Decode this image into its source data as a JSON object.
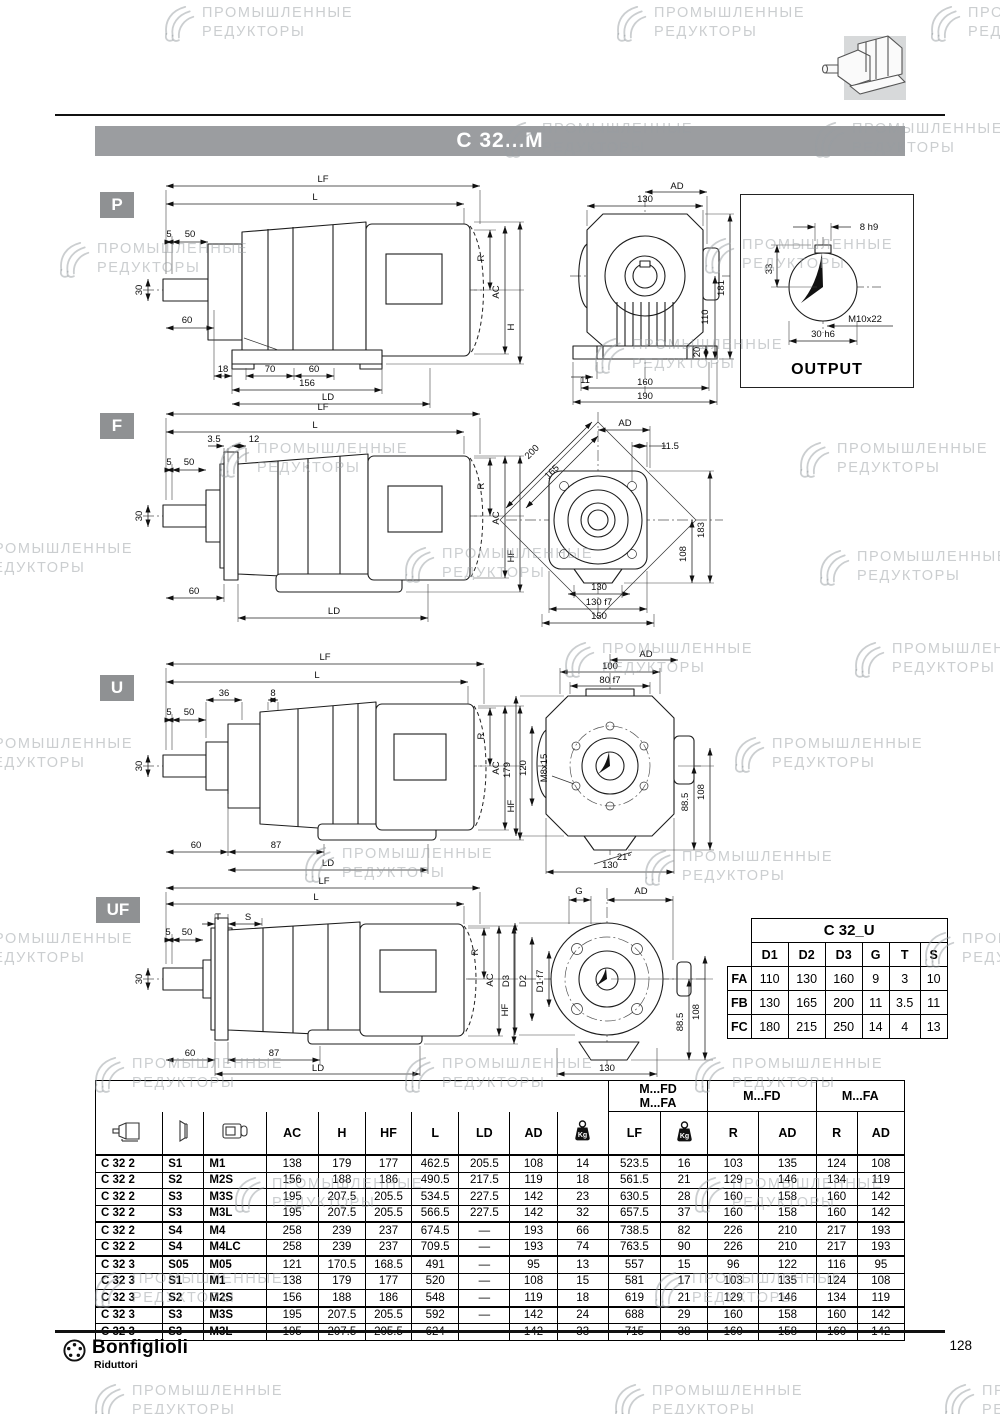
{
  "page": {
    "title": "C 32...M",
    "page_number": "128",
    "brand": "Bonfiglioli",
    "brand_sub": "Riduttori"
  },
  "icons": {
    "gearbox": "gearbox-icon",
    "flange": "flange-icon",
    "motor": "motor-icon",
    "kg": "kg-icon",
    "brand": "bonfiglioli-logo"
  },
  "sections": {
    "p": {
      "badge": "P"
    },
    "f": {
      "badge": "F"
    },
    "u": {
      "badge": "U"
    },
    "uf": {
      "badge": "UF"
    }
  },
  "watermarks": {
    "line1": "ПРОМЫШЛЕННЫЕ",
    "line2": "РЕДУКТОРЫ",
    "items": [
      {
        "x": 160,
        "y": 4
      },
      {
        "x": 612,
        "y": 4
      },
      {
        "x": 926,
        "y": 4
      },
      {
        "x": 500,
        "y": 120
      },
      {
        "x": 810,
        "y": 120
      },
      {
        "x": 55,
        "y": 240
      },
      {
        "x": 700,
        "y": 236
      },
      {
        "x": 590,
        "y": 336
      },
      {
        "x": 215,
        "y": 440
      },
      {
        "x": 795,
        "y": 440
      },
      {
        "x": -60,
        "y": 540
      },
      {
        "x": 400,
        "y": 545
      },
      {
        "x": 815,
        "y": 548
      },
      {
        "x": 560,
        "y": 640
      },
      {
        "x": 850,
        "y": 640
      },
      {
        "x": -60,
        "y": 735
      },
      {
        "x": 730,
        "y": 735
      },
      {
        "x": 300,
        "y": 845
      },
      {
        "x": 640,
        "y": 848
      },
      {
        "x": -60,
        "y": 930
      },
      {
        "x": 920,
        "y": 930
      },
      {
        "x": 90,
        "y": 1055
      },
      {
        "x": 400,
        "y": 1055
      },
      {
        "x": 690,
        "y": 1055
      },
      {
        "x": 230,
        "y": 1175
      },
      {
        "x": 690,
        "y": 1175
      },
      {
        "x": 90,
        "y": 1270
      },
      {
        "x": 650,
        "y": 1270
      },
      {
        "x": 90,
        "y": 1382
      },
      {
        "x": 610,
        "y": 1382
      },
      {
        "x": 940,
        "y": 1382
      }
    ]
  },
  "drawings": {
    "p_side": {
      "labels": [
        {
          "t": "LF",
          "x": 195,
          "y": 12
        },
        {
          "t": "L",
          "x": 187,
          "y": 30
        },
        {
          "t": "5",
          "x": 41,
          "y": 67,
          "fs": 8.5
        },
        {
          "t": "50",
          "x": 62,
          "y": 67,
          "fs": 8.5
        },
        {
          "t": "30",
          "x": 14,
          "y": 120,
          "r": -90,
          "fs": 8.5
        },
        {
          "t": "60",
          "x": 59,
          "y": 153,
          "fs": 8.5
        },
        {
          "t": "18",
          "x": 95,
          "y": 202,
          "fs": 8.5
        },
        {
          "t": "70",
          "x": 142,
          "y": 202,
          "fs": 8.5
        },
        {
          "t": "60",
          "x": 186,
          "y": 202,
          "fs": 8.5
        },
        {
          "t": "156",
          "x": 179,
          "y": 216
        },
        {
          "t": "LD",
          "x": 200,
          "y": 230
        },
        {
          "t": "R",
          "x": 356,
          "y": 88,
          "r": -90
        },
        {
          "t": "AC",
          "x": 371,
          "y": 122,
          "r": -90
        },
        {
          "t": "H",
          "x": 386,
          "y": 157,
          "r": -90
        }
      ]
    },
    "p_rear": {
      "labels": [
        {
          "t": "AD",
          "x": 132,
          "y": 9
        },
        {
          "t": "130",
          "x": 100,
          "y": 22
        },
        {
          "t": "181",
          "x": 179,
          "y": 108,
          "r": -90
        },
        {
          "t": "110",
          "x": 163,
          "y": 137,
          "r": -90
        },
        {
          "t": "20",
          "x": 155,
          "y": 172,
          "r": -90,
          "fs": 8
        },
        {
          "t": "11",
          "x": 40,
          "y": 203,
          "fs": 8.5
        },
        {
          "t": "160",
          "x": 100,
          "y": 205
        },
        {
          "t": "190",
          "x": 100,
          "y": 219
        }
      ]
    },
    "output": {
      "caption": "OUTPUT",
      "labels": [
        {
          "t": "8 h9",
          "x": 128,
          "y": 35,
          "fs": 8.5
        },
        {
          "t": "33",
          "x": 31,
          "y": 74,
          "r": -90
        },
        {
          "t": "M10x22",
          "x": 124,
          "y": 127
        },
        {
          "t": "30 h6",
          "x": 82,
          "y": 142
        }
      ]
    },
    "f_side": {
      "labels": [
        {
          "t": "LF",
          "x": 195,
          "y": 12
        },
        {
          "t": "L",
          "x": 187,
          "y": 30
        },
        {
          "t": "3.5",
          "x": 86,
          "y": 44,
          "fs": 8.5
        },
        {
          "t": "12",
          "x": 126,
          "y": 44,
          "fs": 8.5
        },
        {
          "t": "5",
          "x": 41,
          "y": 67,
          "fs": 8.5
        },
        {
          "t": "50",
          "x": 61,
          "y": 67,
          "fs": 8.5
        },
        {
          "t": "30",
          "x": 14,
          "y": 118,
          "r": -90,
          "fs": 8.5
        },
        {
          "t": "60",
          "x": 66,
          "y": 196,
          "fs": 8.5
        },
        {
          "t": "LD",
          "x": 206,
          "y": 216
        },
        {
          "t": "R",
          "x": 356,
          "y": 88,
          "r": -90
        },
        {
          "t": "AC",
          "x": 371,
          "y": 120,
          "r": -90
        },
        {
          "t": "HF",
          "x": 386,
          "y": 158,
          "r": -90
        }
      ]
    },
    "f_rear": {
      "labels": [
        {
          "t": "AD",
          "x": 127,
          "y": 24
        },
        {
          "t": "11.5",
          "x": 172,
          "y": 47,
          "fs": 8.5
        },
        {
          "t": "200",
          "x": 36,
          "y": 52,
          "r": -45
        },
        {
          "t": "165",
          "x": 56,
          "y": 72,
          "r": -45
        },
        {
          "t": "183",
          "x": 206,
          "y": 128,
          "r": -90
        },
        {
          "t": "108",
          "x": 188,
          "y": 152,
          "r": -90
        },
        {
          "t": "130",
          "x": 101,
          "y": 188
        },
        {
          "t": "130 f7",
          "x": 101,
          "y": 203,
          "fs": 9
        },
        {
          "t": "150",
          "x": 101,
          "y": 217
        }
      ]
    },
    "u_side": {
      "labels": [
        {
          "t": "LF",
          "x": 197,
          "y": 12
        },
        {
          "t": "L",
          "x": 189,
          "y": 30
        },
        {
          "t": "36",
          "x": 96,
          "y": 48,
          "fs": 8.5
        },
        {
          "t": "8",
          "x": 145,
          "y": 48,
          "fs": 8.5
        },
        {
          "t": "5",
          "x": 41,
          "y": 67,
          "fs": 8.5
        },
        {
          "t": "50",
          "x": 61,
          "y": 67,
          "fs": 8.5
        },
        {
          "t": "30",
          "x": 14,
          "y": 118,
          "r": -90,
          "fs": 8.5
        },
        {
          "t": "60",
          "x": 68,
          "y": 200,
          "fs": 8.5
        },
        {
          "t": "87",
          "x": 148,
          "y": 200,
          "fs": 8.5
        },
        {
          "t": "LD",
          "x": 200,
          "y": 218
        },
        {
          "t": "R",
          "x": 356,
          "y": 88,
          "r": -90
        },
        {
          "t": "AC",
          "x": 371,
          "y": 120,
          "r": -90
        },
        {
          "t": "HF",
          "x": 386,
          "y": 158,
          "r": -90
        }
      ]
    },
    "u_rear": {
      "labels": [
        {
          "t": "AD",
          "x": 148,
          "y": 7
        },
        {
          "t": "100",
          "x": 112,
          "y": 19
        },
        {
          "t": "80 f7",
          "x": 112,
          "y": 33,
          "fs": 9
        },
        {
          "t": "179",
          "x": 12,
          "y": 120,
          "r": -90
        },
        {
          "t": "120",
          "x": 28,
          "y": 118,
          "r": -90
        },
        {
          "t": "M8x15",
          "x": 49,
          "y": 118,
          "r": -90,
          "fs": 8.5
        },
        {
          "t": "88.5",
          "x": 190,
          "y": 152,
          "r": -90
        },
        {
          "t": "108",
          "x": 206,
          "y": 142,
          "r": -90
        },
        {
          "t": "21°",
          "x": 126,
          "y": 210,
          "fs": 8.5
        },
        {
          "t": "130",
          "x": 112,
          "y": 218
        }
      ]
    },
    "uf_side": {
      "labels": [
        {
          "t": "LF",
          "x": 196,
          "y": 10
        },
        {
          "t": "L",
          "x": 188,
          "y": 26
        },
        {
          "t": "T",
          "x": 90,
          "y": 46,
          "fs": 9
        },
        {
          "t": "S",
          "x": 120,
          "y": 46,
          "fs": 9
        },
        {
          "t": "5",
          "x": 40,
          "y": 61,
          "fs": 8.5
        },
        {
          "t": "50",
          "x": 59,
          "y": 61,
          "fs": 8.5
        },
        {
          "t": "30",
          "x": 14,
          "y": 105,
          "r": -90,
          "fs": 8.5
        },
        {
          "t": "60",
          "x": 62,
          "y": 182,
          "fs": 8.5
        },
        {
          "t": "87",
          "x": 146,
          "y": 182,
          "fs": 8.5
        },
        {
          "t": "LD",
          "x": 190,
          "y": 197
        },
        {
          "t": "R",
          "x": 350,
          "y": 78,
          "r": -90
        },
        {
          "t": "AC",
          "x": 365,
          "y": 106,
          "r": -90
        },
        {
          "t": "HF",
          "x": 380,
          "y": 136,
          "r": -90
        }
      ]
    },
    "uf_rear": {
      "labels": [
        {
          "t": "G",
          "x": 84,
          "y": 10
        },
        {
          "t": "AD",
          "x": 146,
          "y": 10
        },
        {
          "t": "D3",
          "x": 14,
          "y": 97,
          "r": -90
        },
        {
          "t": "D2",
          "x": 31,
          "y": 97,
          "r": -90
        },
        {
          "t": "D1 f7",
          "x": 48,
          "y": 97,
          "r": -90,
          "fs": 8.5
        },
        {
          "t": "88.5",
          "x": 188,
          "y": 138,
          "r": -90
        },
        {
          "t": "108",
          "x": 204,
          "y": 128,
          "r": -90
        },
        {
          "t": "130",
          "x": 112,
          "y": 187
        }
      ]
    }
  },
  "c32u": {
    "title": "C 32_U",
    "columns": [
      "D1",
      "D2",
      "D3",
      "G",
      "T",
      "S"
    ],
    "rows": [
      {
        "label": "FA",
        "values": [
          "110",
          "130",
          "160",
          "9",
          "3",
          "10"
        ]
      },
      {
        "label": "FB",
        "values": [
          "130",
          "165",
          "200",
          "11",
          "3.5",
          "11"
        ]
      },
      {
        "label": "FC",
        "values": [
          "180",
          "215",
          "250",
          "14",
          "4",
          "13"
        ]
      }
    ]
  },
  "main_table": {
    "group_fd_fa_line1": "M...FD",
    "group_fd_fa_line2": "M...FA",
    "group_fd": "M...FD",
    "group_fa": "M...FA",
    "kg_label": "Kg",
    "cols": {
      "ac": "AC",
      "h": "H",
      "hf": "HF",
      "l": "L",
      "ld": "LD",
      "ad": "AD",
      "lf": "LF",
      "r": "R"
    },
    "rows": [
      {
        "c": [
          "C 32 2",
          "S1",
          "M1",
          "138",
          "179",
          "177",
          "462.5",
          "205.5",
          "108",
          "14",
          "523.5",
          "16",
          "103",
          "135",
          "124",
          "108"
        ]
      },
      {
        "c": [
          "C 32 2",
          "S2",
          "M2S",
          "156",
          "188",
          "186",
          "490.5",
          "217.5",
          "119",
          "18",
          "561.5",
          "21",
          "129",
          "146",
          "134",
          "119"
        ]
      },
      {
        "c": [
          "C 32 2",
          "S3",
          "M3S",
          "195",
          "207.5",
          "205.5",
          "534.5",
          "227.5",
          "142",
          "23",
          "630.5",
          "28",
          "160",
          "158",
          "160",
          "142"
        ]
      },
      {
        "c": [
          "C 32 2",
          "S3",
          "M3L",
          "195",
          "207.5",
          "205.5",
          "566.5",
          "227.5",
          "142",
          "32",
          "657.5",
          "37",
          "160",
          "158",
          "160",
          "142"
        ]
      },
      {
        "c": [
          "C 32 2",
          "S4",
          "M4",
          "258",
          "239",
          "237",
          "674.5",
          "—",
          "193",
          "66",
          "738.5",
          "82",
          "226",
          "210",
          "217",
          "193"
        ],
        "t": 1
      },
      {
        "c": [
          "C 32 2",
          "S4",
          "M4LC",
          "258",
          "239",
          "237",
          "709.5",
          "—",
          "193",
          "74",
          "763.5",
          "90",
          "226",
          "210",
          "217",
          "193"
        ]
      },
      {
        "c": [
          "C 32 3",
          "S05",
          "M05",
          "121",
          "170.5",
          "168.5",
          "491",
          "—",
          "95",
          "13",
          "557",
          "15",
          "96",
          "122",
          "116",
          "95"
        ],
        "t": 1
      },
      {
        "c": [
          "C 32 3",
          "S1",
          "M1",
          "138",
          "179",
          "177",
          "520",
          "—",
          "108",
          "15",
          "581",
          "17",
          "103",
          "135",
          "124",
          "108"
        ]
      },
      {
        "c": [
          "C 32 3",
          "S2",
          "M2S",
          "156",
          "188",
          "186",
          "548",
          "—",
          "119",
          "18",
          "619",
          "21",
          "129",
          "146",
          "134",
          "119"
        ]
      },
      {
        "c": [
          "C 32 3",
          "S3",
          "M3S",
          "195",
          "207.5",
          "205.5",
          "592",
          "—",
          "142",
          "24",
          "688",
          "29",
          "160",
          "158",
          "160",
          "142"
        ],
        "t": 1
      },
      {
        "c": [
          "C 32 3",
          "S3",
          "M3L",
          "195",
          "207.5",
          "205.5",
          "624",
          "—",
          "142",
          "33",
          "715",
          "38",
          "160",
          "158",
          "160",
          "142"
        ]
      }
    ]
  }
}
